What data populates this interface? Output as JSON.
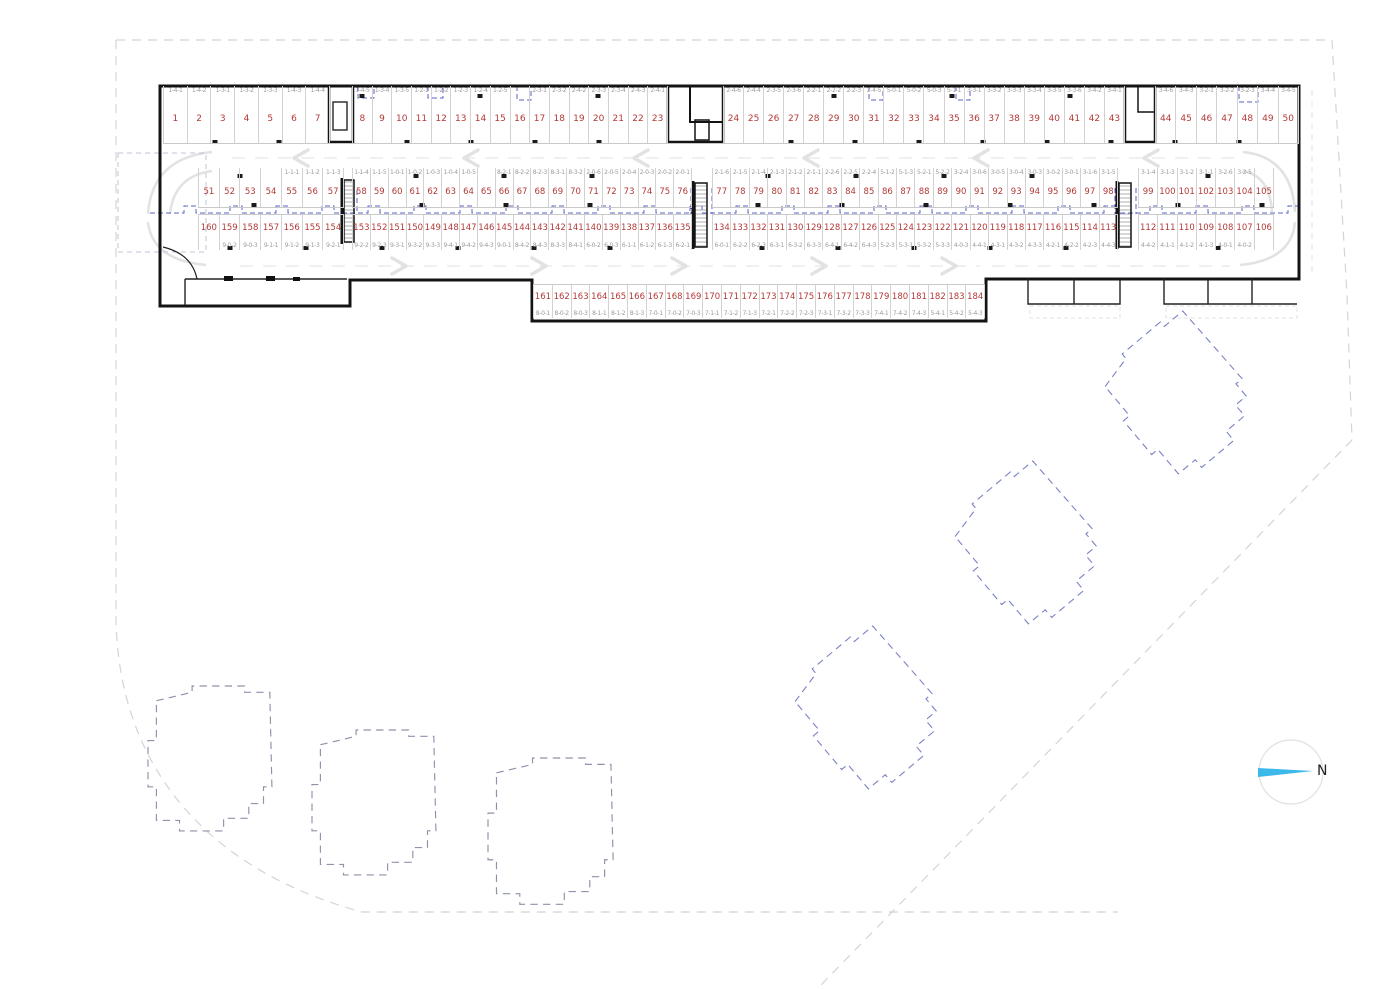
{
  "plan": {
    "north_label": "N",
    "colors": {
      "space_number": "#b23937",
      "space_label": "#9b9b9b",
      "wall": "#141414",
      "overlay_blue": "#5a63c8",
      "building_outline_gray": "#8d93a9",
      "building_outline_blue": "#7a83c4",
      "aisle_marking": "#e2e2e2",
      "site_boundary": "#d4d4d4",
      "north_arrow": "#3cb9e8"
    },
    "rows": {
      "top": [
        {
          "n": "1",
          "l": "1-4-1"
        },
        {
          "n": "2",
          "l": "1-4-2"
        },
        {
          "n": "3",
          "l": "1-3-1"
        },
        {
          "n": "4",
          "l": "1-3-2"
        },
        {
          "n": "5",
          "l": "1-3-3"
        },
        {
          "n": "6",
          "l": "1-4-3"
        },
        {
          "n": "7",
          "l": "1-4-4"
        },
        {
          "n": "8",
          "l": "1-4-5"
        },
        {
          "n": "9",
          "l": "1-3-4"
        },
        {
          "n": "10",
          "l": "1-3-5"
        },
        {
          "n": "11",
          "l": "1-2-1"
        },
        {
          "n": "12",
          "l": "1-2-2"
        },
        {
          "n": "13",
          "l": "1-2-3"
        },
        {
          "n": "14",
          "l": "1-2-4"
        },
        {
          "n": "15",
          "l": "1-2-5"
        },
        {
          "n": "16",
          "l": ""
        },
        {
          "n": "17",
          "l": "2-3-1"
        },
        {
          "n": "18",
          "l": "2-3-2"
        },
        {
          "n": "19",
          "l": "2-4-2"
        },
        {
          "n": "20",
          "l": "2-3-3"
        },
        {
          "n": "21",
          "l": "2-3-4"
        },
        {
          "n": "22",
          "l": "2-4-3"
        },
        {
          "n": "23",
          "l": "2-4-1"
        },
        {
          "n": "24",
          "l": "2-4-6"
        },
        {
          "n": "25",
          "l": "2-4-4"
        },
        {
          "n": "26",
          "l": "2-3-5"
        },
        {
          "n": "27",
          "l": "2-3-6"
        },
        {
          "n": "28",
          "l": "2-2-1"
        },
        {
          "n": "29",
          "l": "2-2-2"
        },
        {
          "n": "30",
          "l": "2-2-3"
        },
        {
          "n": "31",
          "l": "2-4-5"
        },
        {
          "n": "32",
          "l": "5-0-1"
        },
        {
          "n": "33",
          "l": "5-0-2"
        },
        {
          "n": "34",
          "l": "5-0-3"
        },
        {
          "n": "35",
          "l": "5-1-1"
        },
        {
          "n": "36",
          "l": "3-3-1"
        },
        {
          "n": "37",
          "l": "3-3-2"
        },
        {
          "n": "38",
          "l": "3-3-3"
        },
        {
          "n": "39",
          "l": "3-3-4"
        },
        {
          "n": "40",
          "l": "3-3-5"
        },
        {
          "n": "41",
          "l": "3-3-6"
        },
        {
          "n": "42",
          "l": "3-4-2"
        },
        {
          "n": "43",
          "l": "3-4-1"
        },
        {
          "n": "44",
          "l": "3-4-6"
        },
        {
          "n": "45",
          "l": "3-4-3"
        },
        {
          "n": "46",
          "l": "3-2-1"
        },
        {
          "n": "47",
          "l": "3-2-2"
        },
        {
          "n": "48",
          "l": "3-2-3"
        },
        {
          "n": "49",
          "l": "3-4-4"
        },
        {
          "n": "50",
          "l": "3-4-5"
        }
      ],
      "middle_upper": [
        {
          "n": "51",
          "l": ""
        },
        {
          "n": "52",
          "l": ""
        },
        {
          "n": "53",
          "l": ""
        },
        {
          "n": "54",
          "l": ""
        },
        {
          "n": "55",
          "l": "1-1-1"
        },
        {
          "n": "56",
          "l": "1-1-2"
        },
        {
          "n": "57",
          "l": "1-1-3"
        },
        {
          "n": "58",
          "l": "1-1-4"
        },
        {
          "n": "59",
          "l": "1-1-5"
        },
        {
          "n": "60",
          "l": "1-0-1"
        },
        {
          "n": "61",
          "l": "1-0-2"
        },
        {
          "n": "62",
          "l": "1-0-3"
        },
        {
          "n": "63",
          "l": "1-0-4"
        },
        {
          "n": "64",
          "l": "1-0-5"
        },
        {
          "n": "65",
          "l": ""
        },
        {
          "n": "66",
          "l": "8-2-1"
        },
        {
          "n": "67",
          "l": "8-2-2"
        },
        {
          "n": "68",
          "l": "8-2-3"
        },
        {
          "n": "69",
          "l": "8-3-1"
        },
        {
          "n": "70",
          "l": "8-3-2"
        },
        {
          "n": "71",
          "l": "2-0-6"
        },
        {
          "n": "72",
          "l": "2-0-5"
        },
        {
          "n": "73",
          "l": "2-0-4"
        },
        {
          "n": "74",
          "l": "2-0-3"
        },
        {
          "n": "75",
          "l": "2-0-2"
        },
        {
          "n": "76",
          "l": "2-0-1"
        },
        {
          "n": "77",
          "l": "2-1-6"
        },
        {
          "n": "78",
          "l": "2-1-5"
        },
        {
          "n": "79",
          "l": "2-1-4"
        },
        {
          "n": "80",
          "l": "2-1-3"
        },
        {
          "n": "81",
          "l": "2-1-2"
        },
        {
          "n": "82",
          "l": "2-1-1"
        },
        {
          "n": "83",
          "l": "2-2-6"
        },
        {
          "n": "84",
          "l": "2-2-5"
        },
        {
          "n": "85",
          "l": "2-2-4"
        },
        {
          "n": "86",
          "l": "5-1-2"
        },
        {
          "n": "87",
          "l": "5-1-3"
        },
        {
          "n": "88",
          "l": "5-2-1"
        },
        {
          "n": "89",
          "l": "5-2-2"
        },
        {
          "n": "90",
          "l": "3-2-4"
        },
        {
          "n": "91",
          "l": "3-0-6"
        },
        {
          "n": "92",
          "l": "3-0-5"
        },
        {
          "n": "93",
          "l": "3-0-4"
        },
        {
          "n": "94",
          "l": "3-0-3"
        },
        {
          "n": "95",
          "l": "3-0-2"
        },
        {
          "n": "96",
          "l": "3-0-1"
        },
        {
          "n": "97",
          "l": "3-1-6"
        },
        {
          "n": "98",
          "l": "3-1-5"
        },
        {
          "n": "99",
          "l": "3-1-4"
        },
        {
          "n": "100",
          "l": "3-1-3"
        },
        {
          "n": "101",
          "l": "3-1-2"
        },
        {
          "n": "102",
          "l": "3-1-1"
        },
        {
          "n": "103",
          "l": "3-2-6"
        },
        {
          "n": "104",
          "l": "3-2-5"
        },
        {
          "n": "105",
          "l": ""
        }
      ],
      "middle_lower": [
        {
          "n": "160",
          "l": ""
        },
        {
          "n": "159",
          "l": "9-0-2"
        },
        {
          "n": "158",
          "l": "9-0-3"
        },
        {
          "n": "157",
          "l": "9-1-1"
        },
        {
          "n": "156",
          "l": "9-1-2"
        },
        {
          "n": "155",
          "l": "9-1-3"
        },
        {
          "n": "154",
          "l": "9-2-1"
        },
        {
          "n": "153",
          "l": "9-2-2"
        },
        {
          "n": "152",
          "l": "9-2-3"
        },
        {
          "n": "151",
          "l": "9-3-1"
        },
        {
          "n": "150",
          "l": "9-3-2"
        },
        {
          "n": "149",
          "l": "9-3-3"
        },
        {
          "n": "148",
          "l": "9-4-1"
        },
        {
          "n": "147",
          "l": "9-4-2"
        },
        {
          "n": "146",
          "l": "9-4-3"
        },
        {
          "n": "145",
          "l": "9-0-1"
        },
        {
          "n": "144",
          "l": "8-4-2"
        },
        {
          "n": "143",
          "l": "8-4-3"
        },
        {
          "n": "142",
          "l": "8-3-3"
        },
        {
          "n": "141",
          "l": "8-4-1"
        },
        {
          "n": "140",
          "l": "6-0-2"
        },
        {
          "n": "139",
          "l": "6-0-3"
        },
        {
          "n": "138",
          "l": "6-1-1"
        },
        {
          "n": "137",
          "l": "6-1-2"
        },
        {
          "n": "136",
          "l": "6-1-3"
        },
        {
          "n": "135",
          "l": "6-2-1"
        },
        {
          "n": "134",
          "l": "6-0-1"
        },
        {
          "n": "133",
          "l": "6-2-2"
        },
        {
          "n": "132",
          "l": "6-2-3"
        },
        {
          "n": "131",
          "l": "6-3-1"
        },
        {
          "n": "130",
          "l": "6-3-2"
        },
        {
          "n": "129",
          "l": "6-3-3"
        },
        {
          "n": "128",
          "l": "6-4-1"
        },
        {
          "n": "127",
          "l": "6-4-2"
        },
        {
          "n": "126",
          "l": "6-4-3"
        },
        {
          "n": "125",
          "l": "5-2-3"
        },
        {
          "n": "124",
          "l": "5-3-1"
        },
        {
          "n": "123",
          "l": "5-3-2"
        },
        {
          "n": "122",
          "l": "5-3-3"
        },
        {
          "n": "121",
          "l": "4-0-3"
        },
        {
          "n": "120",
          "l": "4-4-1"
        },
        {
          "n": "119",
          "l": "4-3-1"
        },
        {
          "n": "118",
          "l": "4-3-2"
        },
        {
          "n": "117",
          "l": "4-3-3"
        },
        {
          "n": "116",
          "l": "4-2-1"
        },
        {
          "n": "115",
          "l": "4-2-2"
        },
        {
          "n": "114",
          "l": "4-2-3"
        },
        {
          "n": "113",
          "l": "4-4-3"
        },
        {
          "n": "112",
          "l": "4-4-2"
        },
        {
          "n": "111",
          "l": "4-1-1"
        },
        {
          "n": "110",
          "l": "4-1-2"
        },
        {
          "n": "109",
          "l": "4-1-3"
        },
        {
          "n": "108",
          "l": "4-0-1"
        },
        {
          "n": "107",
          "l": "4-0-2"
        },
        {
          "n": "106",
          "l": ""
        }
      ],
      "bottom": [
        {
          "n": "161",
          "l": "8-0-1"
        },
        {
          "n": "162",
          "l": "8-0-2"
        },
        {
          "n": "163",
          "l": "8-0-3"
        },
        {
          "n": "164",
          "l": "8-1-1"
        },
        {
          "n": "165",
          "l": "8-1-2"
        },
        {
          "n": "166",
          "l": "8-1-3"
        },
        {
          "n": "167",
          "l": "7-0-1"
        },
        {
          "n": "168",
          "l": "7-0-2"
        },
        {
          "n": "169",
          "l": "7-0-3"
        },
        {
          "n": "170",
          "l": "7-1-1"
        },
        {
          "n": "171",
          "l": "7-1-2"
        },
        {
          "n": "172",
          "l": "7-1-3"
        },
        {
          "n": "173",
          "l": "7-2-1"
        },
        {
          "n": "174",
          "l": "7-2-2"
        },
        {
          "n": "175",
          "l": "7-2-3"
        },
        {
          "n": "176",
          "l": "7-3-1"
        },
        {
          "n": "177",
          "l": "7-3-2"
        },
        {
          "n": "178",
          "l": "7-3-3"
        },
        {
          "n": "179",
          "l": "7-4-1"
        },
        {
          "n": "180",
          "l": "7-4-2"
        },
        {
          "n": "181",
          "l": "7-4-3"
        },
        {
          "n": "182",
          "l": "5-4-1"
        },
        {
          "n": "183",
          "l": "5-4-2"
        },
        {
          "n": "184",
          "l": "5-4-3"
        }
      ]
    }
  }
}
